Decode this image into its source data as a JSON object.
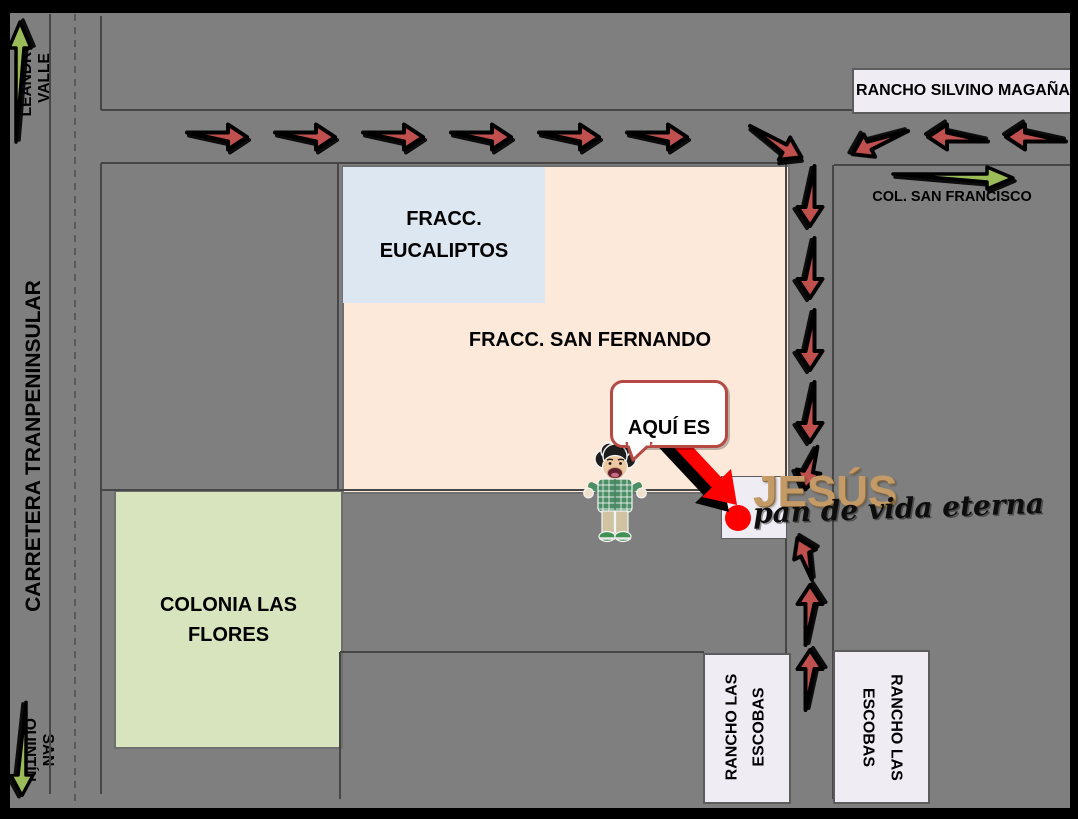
{
  "colors": {
    "bg": "#7f7f7f",
    "line": "#464646",
    "frame": "#000000",
    "region-tan": "#fce9da",
    "region-blue": "#dde7f1",
    "region-green": "#d7e4bd",
    "box-white": "#efecf4",
    "arrow-red": "#c0504d",
    "arrow-green": "#9bbb59",
    "pointer-red": "#fe0000",
    "bubble-border": "#b54a44",
    "logo-tan": "#c49a66",
    "text": "#000000"
  },
  "labels": {
    "leandro_valle": "LEANDRO VALLE",
    "carretera_tranpeninsular": "CARRETERA TRANPENINSULAR",
    "san_quintin": "SAN QUINTÍN",
    "rancho_silvino_magana": "RANCHO SILVINO MAGAÑA",
    "col_san_francisco": "COL. SAN FRANCISCO",
    "fracc_eucaliptos": "FRACC.\nEUCALIPTOS",
    "fracc_san_fernando": "FRACC. SAN FERNANDO",
    "colonia_las_flores": "COLONIA LAS\nFLORES",
    "rancho_las_escobas": "RANCHO LAS\nESCOBAS",
    "aqui_es": "AQUÍ ES"
  },
  "logo": {
    "title": "JESÚS",
    "subtitle": "pan de vida eterna"
  }
}
